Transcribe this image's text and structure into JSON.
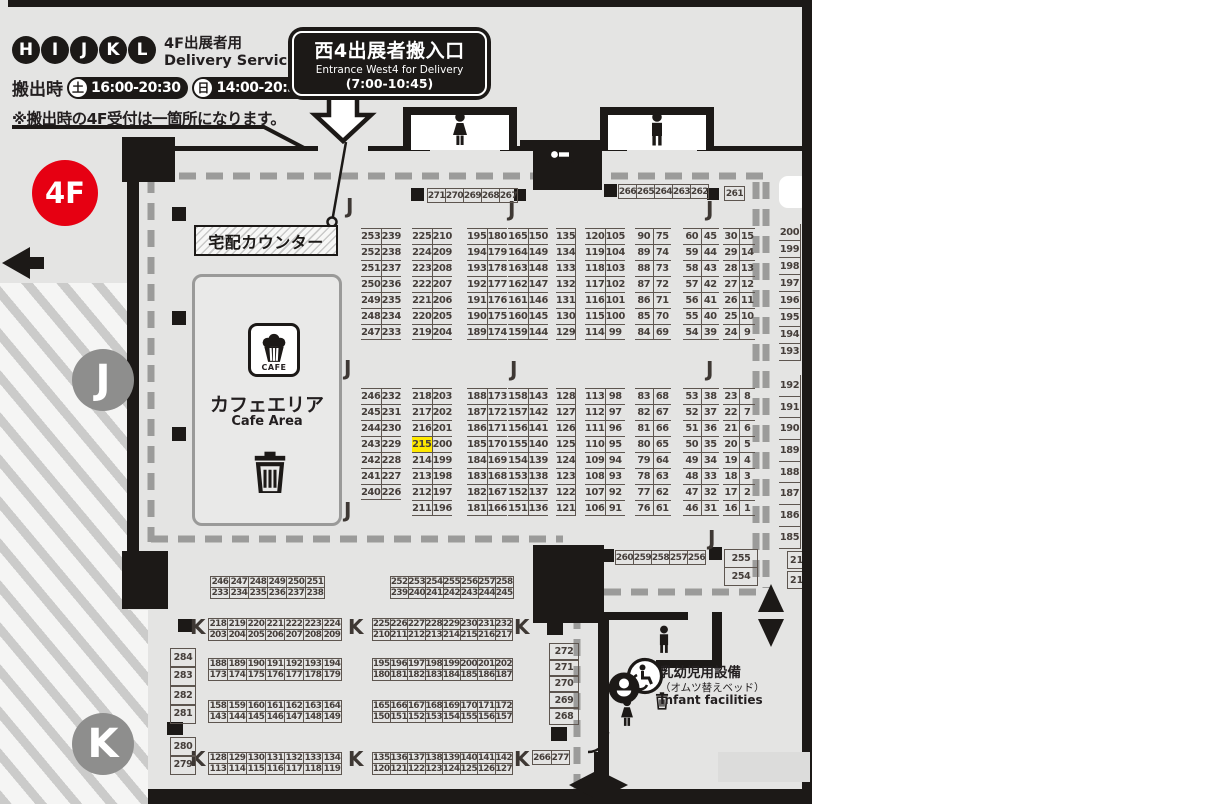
{
  "badge": "4F",
  "letters": {
    "j": "J",
    "k": "K"
  },
  "legend": {
    "letters": [
      "H",
      "I",
      "J",
      "K",
      "L"
    ],
    "service_jp": "4F出展者用",
    "service_en": "Delivery Service",
    "times_label": "搬出時",
    "sat_label": "土",
    "sat_time": "16:00-20:30",
    "sun_label": "日",
    "sun_time": "14:00-20:30",
    "note": "※搬出時の4F受付は一箇所になります。"
  },
  "entrance": {
    "title": "西4出展者搬入口",
    "subtitle": "Entrance West4 for Delivery",
    "hours": "(7:00-10:45)"
  },
  "counter_label": "宅配カウンター",
  "cafe": {
    "icon_label": "CAFE",
    "title": "カフェエリア",
    "subtitle": "Cafe Area"
  },
  "infant": {
    "line1": "乳幼児用設備",
    "line2": "（オムツ替えベッド）",
    "line3": "Infant facilities"
  },
  "highlight_booth": "215",
  "j_top": [
    [
      [
        "253",
        "239"
      ],
      [
        "252",
        "238"
      ],
      [
        "251",
        "237"
      ],
      [
        "250",
        "236"
      ],
      [
        "249",
        "235"
      ],
      [
        "248",
        "234"
      ],
      [
        "247",
        "233"
      ]
    ],
    [
      [
        "225",
        "210"
      ],
      [
        "224",
        "209"
      ],
      [
        "223",
        "208"
      ],
      [
        "222",
        "207"
      ],
      [
        "221",
        "206"
      ],
      [
        "220",
        "205"
      ],
      [
        "219",
        "204"
      ]
    ],
    [
      [
        "195",
        "180"
      ],
      [
        "194",
        "179"
      ],
      [
        "193",
        "178"
      ],
      [
        "192",
        "177"
      ],
      [
        "191",
        "176"
      ],
      [
        "190",
        "175"
      ],
      [
        "189",
        "174"
      ]
    ],
    [
      [
        "165",
        "150"
      ],
      [
        "164",
        "149"
      ],
      [
        "163",
        "148"
      ],
      [
        "162",
        "147"
      ],
      [
        "161",
        "146"
      ],
      [
        "160",
        "145"
      ],
      [
        "159",
        "144"
      ]
    ],
    [
      [
        "135"
      ],
      [
        "134"
      ],
      [
        "133"
      ],
      [
        "132"
      ],
      [
        "131"
      ],
      [
        "130"
      ],
      [
        "129"
      ]
    ],
    [
      [
        "120",
        "105"
      ],
      [
        "119",
        "104"
      ],
      [
        "118",
        "103"
      ],
      [
        "117",
        "102"
      ],
      [
        "116",
        "101"
      ],
      [
        "115",
        "100"
      ],
      [
        "114",
        "99"
      ]
    ],
    [
      [
        "90",
        "75"
      ],
      [
        "89",
        "74"
      ],
      [
        "88",
        "73"
      ],
      [
        "87",
        "72"
      ],
      [
        "86",
        "71"
      ],
      [
        "85",
        "70"
      ],
      [
        "84",
        "69"
      ]
    ],
    [
      [
        "60",
        "45"
      ],
      [
        "59",
        "44"
      ],
      [
        "58",
        "43"
      ],
      [
        "57",
        "42"
      ],
      [
        "56",
        "41"
      ],
      [
        "55",
        "40"
      ],
      [
        "54",
        "39"
      ]
    ],
    [
      [
        "30",
        "15"
      ],
      [
        "29",
        "14"
      ],
      [
        "28",
        "13"
      ],
      [
        "27",
        "12"
      ],
      [
        "26",
        "11"
      ],
      [
        "25",
        "10"
      ],
      [
        "24",
        "9"
      ]
    ]
  ],
  "j_top_right": [
    "200",
    "199",
    "198",
    "197",
    "196",
    "195",
    "194",
    "193"
  ],
  "j_mid": [
    [
      [
        "246",
        "232"
      ],
      [
        "245",
        "231"
      ],
      [
        "244",
        "230"
      ],
      [
        "243",
        "229"
      ],
      [
        "242",
        "228"
      ],
      [
        "241",
        "227"
      ],
      [
        "240",
        "226"
      ]
    ],
    [
      [
        "218",
        "203"
      ],
      [
        "217",
        "202"
      ],
      [
        "216",
        "201"
      ],
      [
        "215",
        "200"
      ],
      [
        "214",
        "199"
      ],
      [
        "213",
        "198"
      ],
      [
        "212",
        "197"
      ],
      [
        "211",
        "196"
      ]
    ],
    [
      [
        "188",
        "173"
      ],
      [
        "187",
        "172"
      ],
      [
        "186",
        "171"
      ],
      [
        "185",
        "170"
      ],
      [
        "184",
        "169"
      ],
      [
        "183",
        "168"
      ],
      [
        "182",
        "167"
      ],
      [
        "181",
        "166"
      ]
    ],
    [
      [
        "158",
        "143"
      ],
      [
        "157",
        "142"
      ],
      [
        "156",
        "141"
      ],
      [
        "155",
        "140"
      ],
      [
        "154",
        "139"
      ],
      [
        "153",
        "138"
      ],
      [
        "152",
        "137"
      ],
      [
        "151",
        "136"
      ]
    ],
    [
      [
        "128"
      ],
      [
        "127"
      ],
      [
        "126"
      ],
      [
        "125"
      ],
      [
        "124"
      ],
      [
        "123"
      ],
      [
        "122"
      ],
      [
        "121"
      ]
    ],
    [
      [
        "113",
        "98"
      ],
      [
        "112",
        "97"
      ],
      [
        "111",
        "96"
      ],
      [
        "110",
        "95"
      ],
      [
        "109",
        "94"
      ],
      [
        "108",
        "93"
      ],
      [
        "107",
        "92"
      ],
      [
        "106",
        "91"
      ]
    ],
    [
      [
        "83",
        "68"
      ],
      [
        "82",
        "67"
      ],
      [
        "81",
        "66"
      ],
      [
        "80",
        "65"
      ],
      [
        "79",
        "64"
      ],
      [
        "78",
        "63"
      ],
      [
        "77",
        "62"
      ],
      [
        "76",
        "61"
      ]
    ],
    [
      [
        "53",
        "38"
      ],
      [
        "52",
        "37"
      ],
      [
        "51",
        "36"
      ],
      [
        "50",
        "35"
      ],
      [
        "49",
        "34"
      ],
      [
        "48",
        "33"
      ],
      [
        "47",
        "32"
      ],
      [
        "46",
        "31"
      ]
    ],
    [
      [
        "23",
        "8"
      ],
      [
        "22",
        "7"
      ],
      [
        "21",
        "6"
      ],
      [
        "20",
        "5"
      ],
      [
        "19",
        "4"
      ],
      [
        "18",
        "3"
      ],
      [
        "17",
        "2"
      ],
      [
        "16",
        "1"
      ]
    ]
  ],
  "j_mid_right": [
    "192",
    "191",
    "190",
    "189",
    "188",
    "187",
    "186",
    "185"
  ],
  "j_head": {
    "left": [
      "271",
      "270",
      "269",
      "268",
      "267"
    ],
    "right": [
      "266",
      "265",
      "264",
      "263",
      "262"
    ],
    "single": [
      "261"
    ]
  },
  "j_bottom": {
    "row": [
      "260",
      "259",
      "258",
      "257",
      "256"
    ],
    "pair": [
      "255",
      "254"
    ],
    "clipped": [
      "21",
      "21"
    ]
  },
  "k_left": [
    {
      "top": [
        "246",
        "247",
        "248",
        "249",
        "250",
        "251"
      ],
      "bot": [
        "233",
        "234",
        "235",
        "236",
        "237",
        "238"
      ]
    },
    {
      "top": [
        "218",
        "219",
        "220",
        "221",
        "222",
        "223",
        "224"
      ],
      "bot": [
        "203",
        "204",
        "205",
        "206",
        "207",
        "208",
        "209"
      ]
    },
    {
      "top": [
        "188",
        "189",
        "190",
        "191",
        "192",
        "193",
        "194"
      ],
      "bot": [
        "173",
        "174",
        "175",
        "176",
        "177",
        "178",
        "179"
      ]
    },
    {
      "top": [
        "158",
        "159",
        "160",
        "161",
        "162",
        "163",
        "164"
      ],
      "bot": [
        "143",
        "144",
        "145",
        "146",
        "147",
        "148",
        "149"
      ]
    },
    {
      "top": [
        "128",
        "129",
        "130",
        "131",
        "132",
        "133",
        "134"
      ],
      "bot": [
        "113",
        "114",
        "115",
        "116",
        "117",
        "118",
        "119"
      ]
    }
  ],
  "k_mid": [
    {
      "top": [
        "252",
        "253",
        "254",
        "255",
        "256",
        "257",
        "258"
      ],
      "bot": [
        "239",
        "240",
        "241",
        "242",
        "243",
        "244",
        "245"
      ]
    },
    {
      "top": [
        "225",
        "226",
        "227",
        "228",
        "229",
        "230",
        "231",
        "232"
      ],
      "bot": [
        "210",
        "211",
        "212",
        "213",
        "214",
        "215",
        "216",
        "217"
      ]
    },
    {
      "top": [
        "195",
        "196",
        "197",
        "198",
        "199",
        "200",
        "201",
        "202"
      ],
      "bot": [
        "180",
        "181",
        "182",
        "183",
        "184",
        "185",
        "186",
        "187"
      ]
    },
    {
      "top": [
        "165",
        "166",
        "167",
        "168",
        "169",
        "170",
        "171",
        "172"
      ],
      "bot": [
        "150",
        "151",
        "152",
        "153",
        "154",
        "155",
        "156",
        "157"
      ]
    },
    {
      "top": [
        "135",
        "136",
        "137",
        "138",
        "139",
        "140",
        "141",
        "142"
      ],
      "bot": [
        "120",
        "121",
        "122",
        "123",
        "124",
        "125",
        "126",
        "127"
      ]
    }
  ],
  "k_side": {
    "left_pairs": [
      [
        "284",
        "283"
      ],
      [
        "282",
        "281"
      ],
      [
        "280",
        "279"
      ]
    ],
    "right_col": [
      "272",
      "271",
      "270",
      "269",
      "268"
    ],
    "bottom_pair": [
      "266",
      "277"
    ]
  }
}
